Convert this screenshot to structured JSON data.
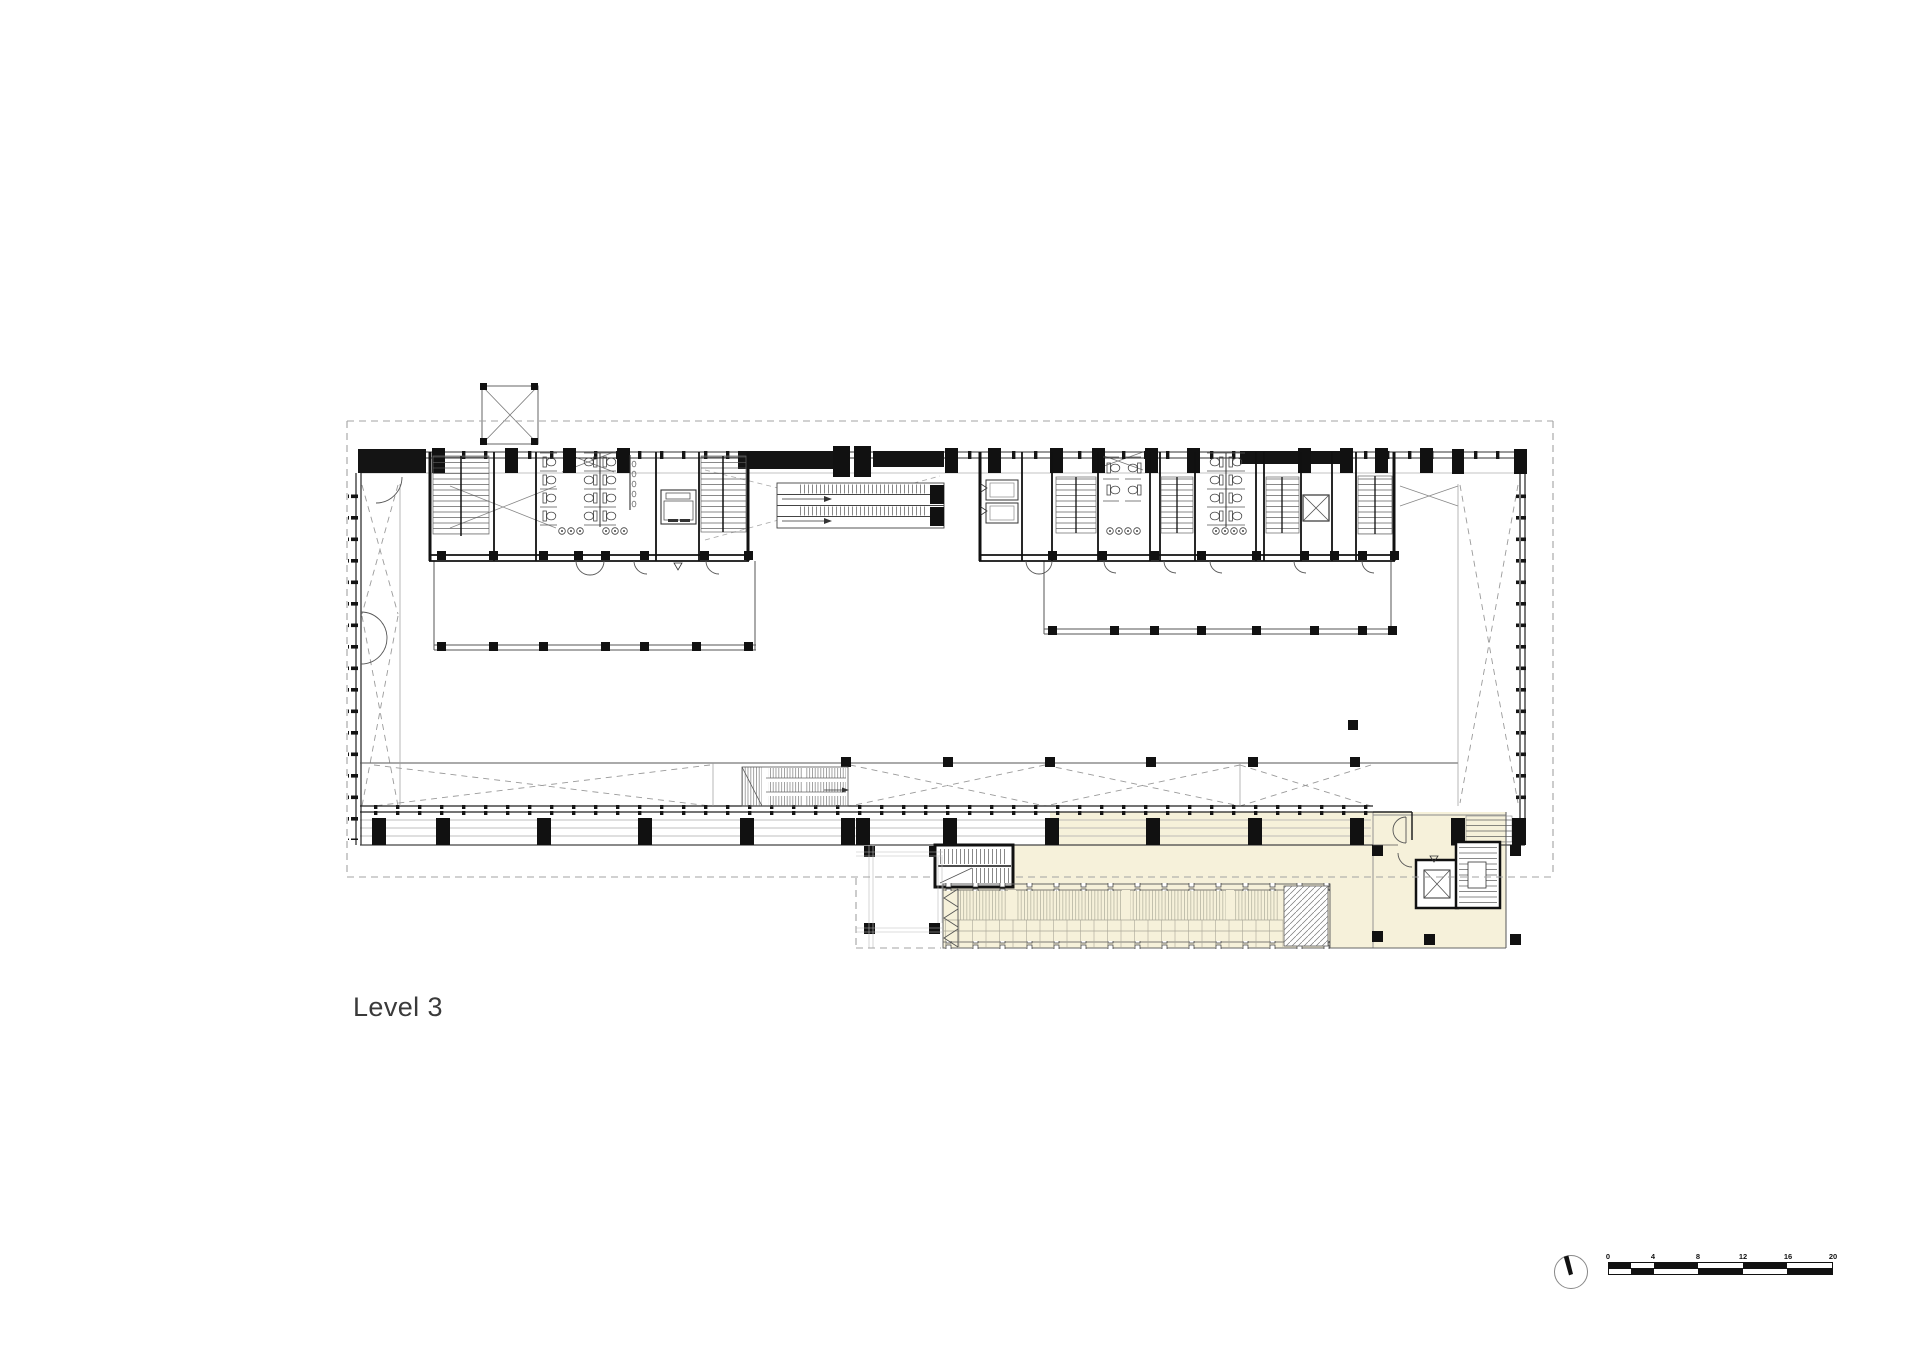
{
  "page": {
    "background_color": "#ffffff",
    "width_px": 1920,
    "height_px": 1357
  },
  "floor_plan": {
    "label": "Level 3",
    "drawing_type": "architectural floor plan",
    "highlight_fill": "#f6f1da",
    "wall_color": "#141414",
    "line_color": "#777777",
    "boundary_dash_color": "#a3a3a3",
    "features": [
      "dashed site boundary",
      "left core: scissor stair, elevator shaft, toilets, elevator cab, stair",
      "central escalator pair with crossing dashed lines",
      "right core: twin elevators, stairs, toilets, elevator",
      "atrium void strips with dashed cross bracing",
      "perimeter structural columns and wall ticks",
      "south colonnade with heavy columns",
      "stepped seating stair",
      "annex terrace with four columns",
      "annex louvered deck with hatched end block",
      "annex stair core",
      "annex elevator and stair core"
    ]
  },
  "north_arrow": {
    "type": "north-indicator"
  },
  "scale_bar": {
    "unit_labels": [
      "0",
      "4",
      "8",
      "12",
      "16",
      "20"
    ]
  }
}
